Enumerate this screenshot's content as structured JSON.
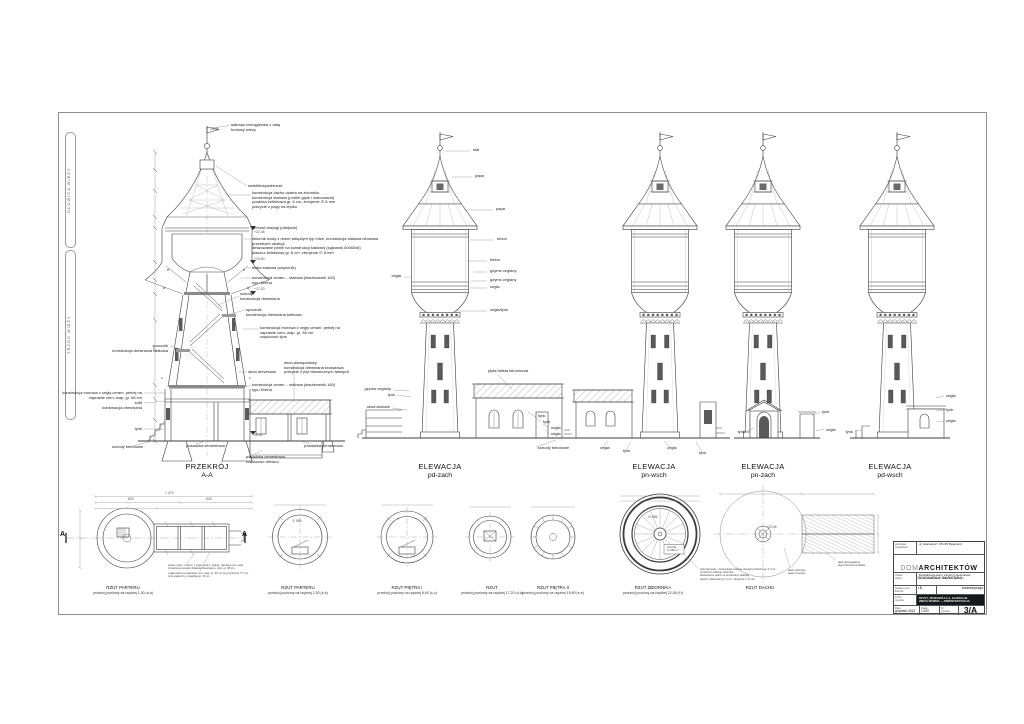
{
  "drawing": {
    "section": {
      "title": "PRZEKRÓJ",
      "subtitle": "A-A"
    },
    "elevations": [
      {
        "title": "ELEWACJA",
        "subtitle": "pd-zach"
      },
      {
        "title": "ELEWACJA",
        "subtitle": "pn-wsch"
      },
      {
        "title": "ELEWACJA",
        "subtitle": "pn-zach"
      },
      {
        "title": "ELEWACJA",
        "subtitle": "pd-wsch"
      }
    ],
    "plans": [
      {
        "title": "RZUT PARTERU",
        "subtitle": "przekrój poziomy na rzędnej 1,00 (a-a)"
      },
      {
        "title": "RZUT PARTERU",
        "subtitle": "przekrój poziomy na rzędnej 2,00 (b-b)"
      },
      {
        "title": "RZUT PIĘTRA I",
        "subtitle": "przekrój poziomy na rzędnej 6,60 (c-c)"
      },
      {
        "title": "RZUT",
        "subtitle": "przekrój poziomy na rzędnej 17,20 (d-d)"
      },
      {
        "title": "RZUT PIĘTRA II",
        "subtitle": "przekrój poziomy na rzędnej 19,60 (e-e)"
      },
      {
        "title": "RZUT ZBIORNIKA",
        "subtitle": "przekrój poziomy na rzędnej 22,48 (f-f)"
      },
      {
        "title": "RZUT DACHU",
        "subtitle": ""
      }
    ],
    "zones": [
      {
        "t": "GŁOWICA WIEŻY"
      },
      {
        "t": "TRZON WIEŻY"
      }
    ],
    "annotations": {
      "section": [
        {
          "t": "stalowa chorągiewka z datą\nbudowy wieży",
          "x": 231,
          "y": 123
        },
        {
          "t": "świetlik/wywietrznik",
          "x": 248,
          "y": 184
        },
        {
          "t": "konstrukcja dachu oparta na zbiorniku\nkonstrukcja stalowa (profile gięte i walcowane)\npowłoka żelbetowa gr. 6 cm, zbrojenie ∅ 8 mm\npokrycie z papy na lepiku",
          "x": 252,
          "y": 191
        },
        {
          "t": "pomost obsługi (obejście)",
          "x": 252,
          "y": 226
        },
        {
          "t": "zbiornik wody z dnem wklęsłym typ Intze, konstrukcja stalowa nitowana\nprzestrzeń obsługi\ndeskowanie pełne na konstrukcji stalowej (kątownik 60x60x6)\npłaszcz żelbetowy gr. 6 cm, zbrojenie ∅ 8 mm",
          "x": 252,
          "y": 237
        },
        {
          "t": "belka stalowa (wspornik)",
          "x": 252,
          "y": 266
        },
        {
          "t": "konstrukcja ceram. - stalowa (dwuteownik 160)\ntypu Kleina",
          "x": 252,
          "y": 276
        },
        {
          "t": "schody\nkonstrukcja drewniana",
          "x": 240,
          "y": 292
        },
        {
          "t": "spocznik\nkonstrukcja drewniana belkowa",
          "x": 246,
          "y": 308
        },
        {
          "t": "konstrukcja murowa z cegły ceram. pełnej na\nzaprawie cem.-wap. gr. 38 cm\nczęściowo tynk",
          "x": 260,
          "y": 326
        },
        {
          "t": "spocznik\nkonstrukcja drewniana belkowa",
          "x": 168,
          "y": 344,
          "r": 1
        },
        {
          "t": "okna drewniane",
          "x": 248,
          "y": 370
        },
        {
          "t": "dach dwuspadowy\nkonstrukcja drewniana krokwiowa\npokrycie z płyt bitumicznych falistych",
          "x": 284,
          "y": 361
        },
        {
          "t": "konstrukcja ceram. - stalowa (dwuteownik 160)\ntypu Kleina",
          "x": 252,
          "y": 383
        },
        {
          "t": "konstrukcja murowa z cegły ceram. pełnej na\nzaprawie cem.-wap. gr. 66 cm",
          "x": 142,
          "y": 391,
          "r": 1
        },
        {
          "t": "sufit\nkonstrukcja drewniana",
          "x": 142,
          "y": 401,
          "r": 1
        },
        {
          "t": "tynk",
          "x": 142,
          "y": 427,
          "r": 1
        },
        {
          "t": "schody betonowe",
          "x": 112,
          "y": 445
        },
        {
          "t": "posadzka cementowa",
          "x": 186,
          "y": 444
        },
        {
          "t": "posadzka cementowa,\nczęściowo drewno",
          "x": 246,
          "y": 455
        },
        {
          "t": "posadzka cementowa",
          "x": 304,
          "y": 444
        }
      ],
      "elevations": [
        {
          "t": "stal",
          "x": 473,
          "y": 148
        },
        {
          "t": "papa",
          "x": 475,
          "y": 174
        },
        {
          "t": "papa",
          "x": 496,
          "y": 207
        },
        {
          "t": "beton",
          "x": 497,
          "y": 237
        },
        {
          "t": "beton",
          "x": 490,
          "y": 258
        },
        {
          "t": "gzyms ceglany",
          "x": 490,
          "y": 269
        },
        {
          "t": "gzyms ceglany",
          "x": 490,
          "y": 278
        },
        {
          "t": "cegła",
          "x": 490,
          "y": 285
        },
        {
          "t": "cegła",
          "x": 401,
          "y": 274,
          "r": 1
        },
        {
          "t": "cegła/tynk",
          "x": 490,
          "y": 308
        },
        {
          "t": "płyta falista bitumiczna",
          "x": 488,
          "y": 369
        },
        {
          "t": "gzyms ceglany",
          "x": 391,
          "y": 387,
          "r": 1
        },
        {
          "t": "tynk",
          "x": 395,
          "y": 393,
          "r": 1
        },
        {
          "t": "okna stalowe",
          "x": 390,
          "y": 405,
          "r": 1
        },
        {
          "t": "tynk",
          "x": 538,
          "y": 414
        },
        {
          "t": "tynk",
          "x": 543,
          "y": 420
        },
        {
          "t": "cegła",
          "x": 551,
          "y": 426
        },
        {
          "t": "cegła",
          "x": 551,
          "y": 432
        },
        {
          "t": "schody betonowe",
          "x": 538,
          "y": 446
        },
        {
          "t": "cegła",
          "x": 600,
          "y": 446
        },
        {
          "t": "tynk",
          "x": 623,
          "y": 449
        },
        {
          "t": "cegła",
          "x": 667,
          "y": 446
        },
        {
          "t": "tynk",
          "x": 699,
          "y": 451
        },
        {
          "t": "tynk",
          "x": 745,
          "y": 430,
          "r": 1
        },
        {
          "t": "tynk",
          "x": 822,
          "y": 410
        },
        {
          "t": "cegła",
          "x": 826,
          "y": 428
        },
        {
          "t": "tynk",
          "x": 853,
          "y": 430,
          "r": 1
        },
        {
          "t": "cegła",
          "x": 946,
          "y": 394
        },
        {
          "t": "tynk",
          "x": 946,
          "y": 408
        },
        {
          "t": "cegła",
          "x": 946,
          "y": 419
        }
      ],
      "plans": [
        {
          "t": "A",
          "x": 60,
          "y": 531,
          "c": "amark"
        },
        {
          "t": "A",
          "x": 242,
          "y": 531,
          "c": "amark"
        },
        {
          "t": "ściany zewn. i wewn. z cegły ceram. pełnej, zaprawa cem.-wap.\n(częściowo ścianki działowe drewniane), tynk; gr. 38 cm",
          "x": 168,
          "y": 564,
          "c": "note"
        },
        {
          "t": "cegła pełna na zaprawie cem.-wap. gr. 66 cm (w przyziemiu 77 cm),\ntynk wapienny; posadzka gr. 30 cm",
          "x": 168,
          "y": 572,
          "c": "note"
        },
        {
          "t": "zbiornik wody - konstrukcja stalowa nitowana (blacha gr. 6 mm)\nprzestrzeń obsługi zbiornika\ndeskowanie pełne na konstrukcji stalowej\npłaszcz żelbetowy gr. 6 cm, zbrojenie ∅ 8 mm",
          "x": 700,
          "y": 568,
          "c": "note"
        },
        {
          "t": "dach dwuspadowy\npłyta bitumiczna falista",
          "x": 838,
          "y": 561,
          "c": "note"
        },
        {
          "t": "dach stożkowy\npapa na lepiku",
          "x": 788,
          "y": 569,
          "c": "note"
        },
        {
          "t": "zbiornik\nV=150 m³",
          "x": 667,
          "y": 546,
          "c": "note"
        }
      ],
      "dims": [
        {
          "t": "23,48",
          "x": 210,
          "y": 128,
          "c": "dim"
        },
        {
          "t": "+22,48",
          "x": 254,
          "y": 231,
          "c": "dim"
        },
        {
          "t": "+19,60",
          "x": 254,
          "y": 258,
          "c": "dim"
        },
        {
          "t": "+17,20",
          "x": 254,
          "y": 288,
          "c": "dim"
        },
        {
          "t": "±0,00",
          "x": 254,
          "y": 434,
          "c": "dim"
        },
        {
          "t": "1 473",
          "x": 165,
          "y": 492,
          "c": "dim"
        },
        {
          "t": "830",
          "x": 128,
          "y": 498,
          "c": "dim"
        },
        {
          "t": "643",
          "x": 206,
          "y": 498,
          "c": "dim"
        },
        {
          "t": "∅ 590",
          "x": 292,
          "y": 520,
          "c": "dim"
        },
        {
          "t": "∅ 886",
          "x": 648,
          "y": 516,
          "c": "dim"
        },
        {
          "t": "+23,48",
          "x": 766,
          "y": 526,
          "c": "dim"
        },
        {
          "t": "d",
          "x": 163,
          "y": 286,
          "c": "mark"
        },
        {
          "t": "d",
          "x": 247,
          "y": 286,
          "c": "mark"
        },
        {
          "t": "e",
          "x": 167,
          "y": 268,
          "c": "mark"
        },
        {
          "t": "e",
          "x": 243,
          "y": 268,
          "c": "mark"
        },
        {
          "t": "c",
          "x": 161,
          "y": 376,
          "c": "mark"
        },
        {
          "t": "c",
          "x": 249,
          "y": 376,
          "c": "mark"
        }
      ]
    }
  },
  "titleblock": {
    "unit_label": "jednostka\nprojektowa",
    "unit_value": "ul. Gdańska 27, 85-005 Bydgoszcz",
    "logo_pre": "DOM",
    "logo_main": "ARCHITEKTÓW",
    "logo_script": "pracownia autorska",
    "object_label": "Obiekt\nAdres",
    "object_value": "Rewitalizacja wieży ciśnień (przebudowa)\nul. Wyzwolenia 27, 89-210 Łabiszyn",
    "stage_label": "Stadium proj.\nBranża",
    "stage_value": "I.B.",
    "stage_value2": "inwentaryzacja",
    "content_label": "Treść\nrysunku",
    "content_value": "RZUTY, PRZEKRÓJ A-A, ELEWACJE\nWIEŻA WODNA — INWENTARYZACJA",
    "date_label": "Data",
    "date_value": "grudzień 2013",
    "scale_label": "Skala",
    "scale_value": "1:100",
    "number_label": "Nr\nrysunku",
    "number_value": "3/A"
  }
}
